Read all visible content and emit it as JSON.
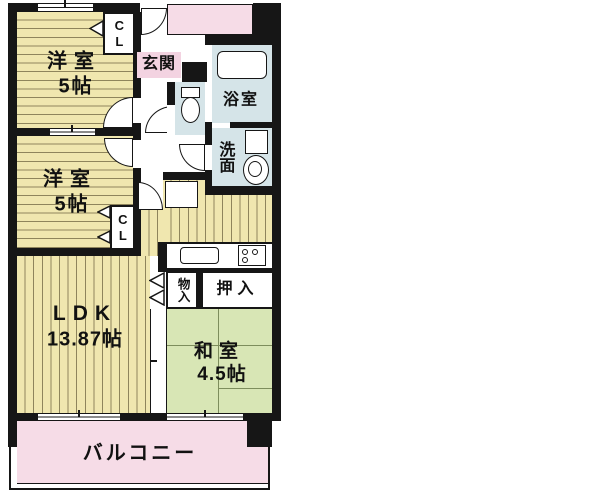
{
  "title": "間取り図",
  "rooms": {
    "yoshitsu1": {
      "label": "洋室",
      "size": "5帖"
    },
    "yoshitsu2": {
      "label": "洋室",
      "size": "5帖"
    },
    "closet1": "CL",
    "closet2": "CL",
    "genkan": "玄関",
    "bath": "浴室",
    "senmen": "洗面",
    "monoiri": "物入",
    "oshiire": "押入",
    "ldk": {
      "label": "LDK",
      "size": "13.87帖"
    },
    "washitsu": {
      "label": "和室",
      "size": "4.5帖"
    },
    "balcony": "バルコニー"
  },
  "colors": {
    "wall": "#161616",
    "flooring": "#f0e7af",
    "wet_area": "#d5e4e8",
    "tatami": "#d8e6b5",
    "balcony_pink": "#f6dce7"
  }
}
